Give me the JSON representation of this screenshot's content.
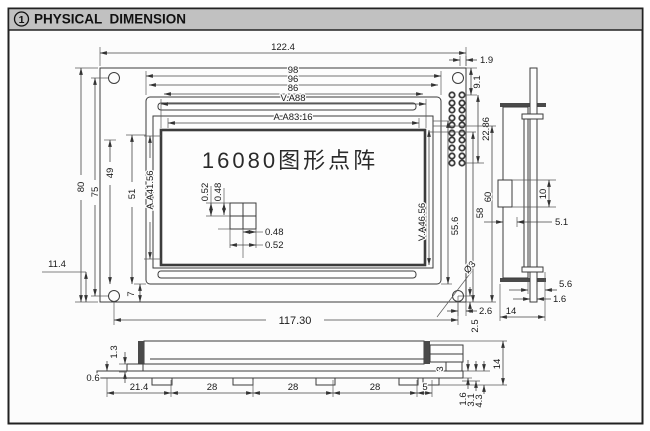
{
  "header": {
    "index": "1",
    "title": "PHYSICAL  DIMENSION"
  },
  "front": {
    "dim_overall_w": "122.4",
    "dim_98": "98",
    "dim_96": "96",
    "dim_86": "86",
    "dim_va_w": "V.A88",
    "dim_aa_w": "A.A83.16",
    "dim_1_9": "1.9",
    "dim_80": "80",
    "dim_75": "75",
    "dim_49": "49",
    "dim_51": "51",
    "dim_aa_h": "A.A41.56",
    "dim_11_4": "11.4",
    "dim_7": "7",
    "dim_9_1": "9.1",
    "dim_22_86": "22.86",
    "dim_58": "58",
    "dim_60": "60",
    "dim_55_6": "55.6",
    "dim_va_h": "V.A46.56",
    "dim_hole": "Ø3",
    "dim_2_6": "2.6",
    "dim_2_5": "2.5",
    "dim_mount_w": "117.30",
    "display_label": "16080图形点阵",
    "dot_v1": "0.52",
    "dot_v2": "0.48",
    "dot_h1": "0.48",
    "dot_h2": "0.52"
  },
  "side": {
    "dim_10": "10",
    "dim_5_1": "5.1",
    "dim_5_6": "5.6",
    "dim_1_6": "1.6",
    "dim_14": "14"
  },
  "bottom": {
    "dim_1_3": "1.3",
    "dim_0_6": "0.6",
    "pitch": [
      "21.4",
      "28",
      "28",
      "28",
      "5"
    ],
    "dim_3": "3",
    "dim_1_6": "1.6",
    "dim_3_1": "3.1",
    "dim_4_3": "4.3",
    "dim_14": "14"
  }
}
